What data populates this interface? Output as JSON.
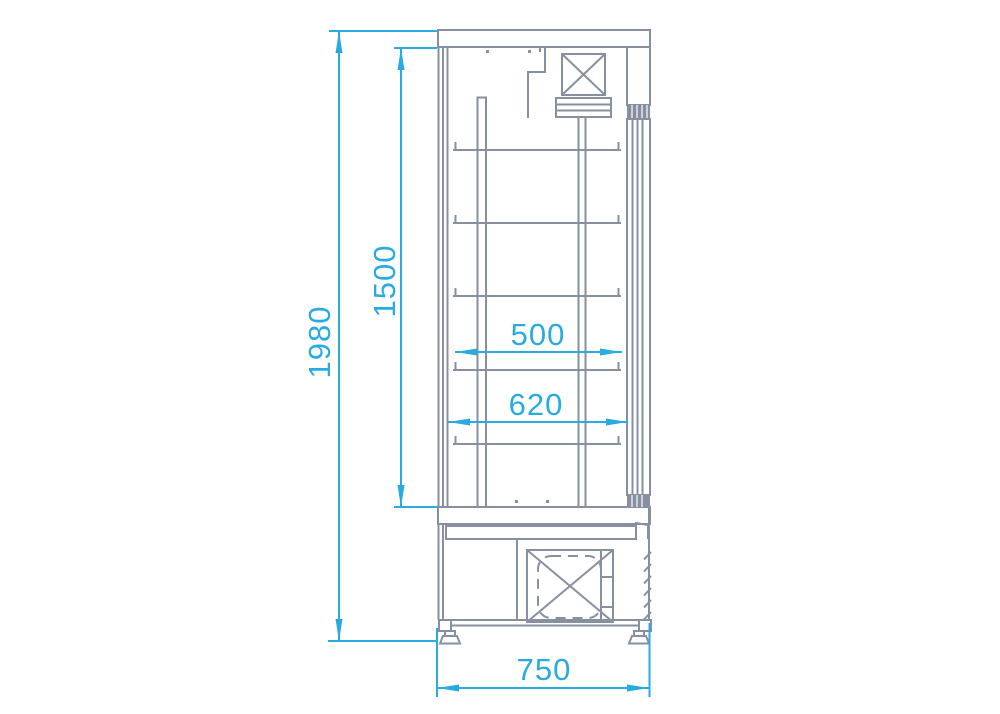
{
  "drawing": {
    "dimensions": {
      "overall_height": "1980",
      "interior_height": "1500",
      "shelf_width_upper": "500",
      "shelf_width_lower": "620",
      "overall_depth": "750"
    },
    "colors": {
      "dimension_accent": "#29abe2",
      "drawing_line": "#8690a0",
      "background": "#ffffff"
    }
  }
}
